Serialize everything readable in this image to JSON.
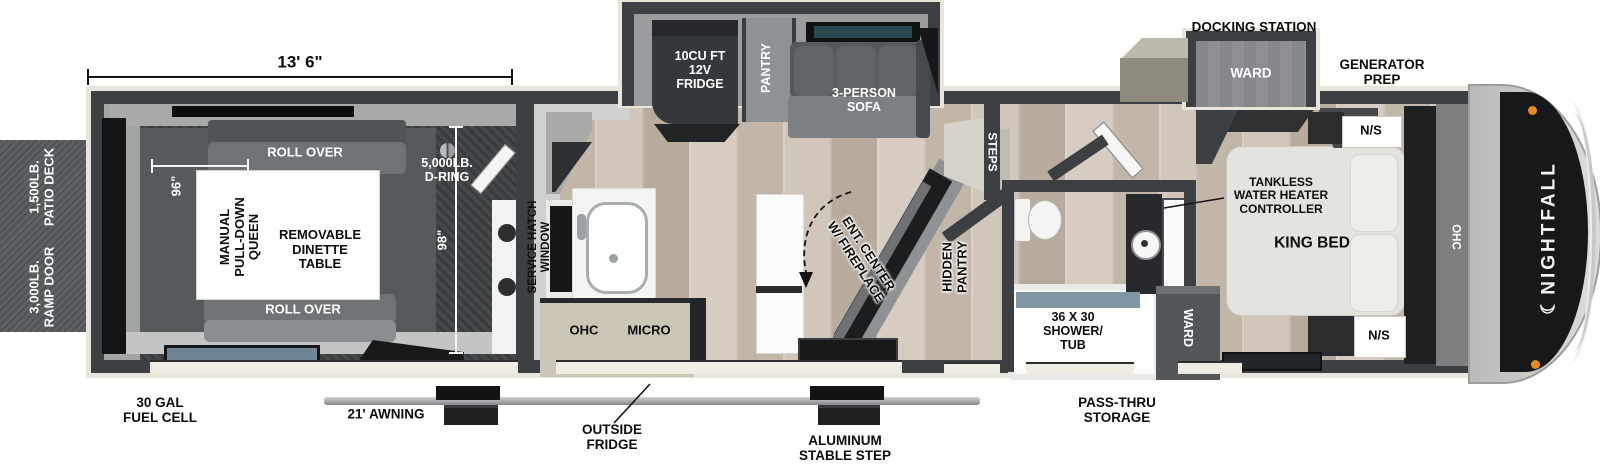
{
  "brand": {
    "logo_text": "NIGHTFALL",
    "moon_icon": "☾"
  },
  "colors": {
    "wall": "#3d4043",
    "outline": "#e9e5da",
    "wood_floor": "#c9beb1",
    "garage_floor": "#45484a",
    "window_teal": "#2b4750",
    "shower_blue": "#7e96a5",
    "cabinet_beige": "#ccc6b7",
    "brand_panel": "#17181a",
    "marker_orange": "#e78c1a",
    "patio_gray": "#5d6163"
  },
  "dimensions": {
    "garage_length": "13' 6\"",
    "garage_width": "96\"",
    "body_width": "98\""
  },
  "exterior": {
    "patio_deck": "1,500LB.\nPATIO DECK",
    "ramp_door": "3,000LB.\nRAMP DOOR",
    "fuel_cell": "30 GAL\nFUEL CELL",
    "awning": "21' AWNING",
    "outside_fridge": "OUTSIDE\nFRIDGE",
    "stable_step": "ALUMINUM\nSTABLE STEP",
    "pass_thru": "PASS-THRU\nSTORAGE",
    "docking_station": "DOCKING STATION",
    "generator_prep": "GENERATOR\nPREP"
  },
  "garage": {
    "roll_over_top": "ROLL OVER",
    "roll_over_bottom": "ROLL OVER",
    "queen_bed": "MANUAL\nPULL-DOWN\nQUEEN",
    "dinette": "REMOVABLE\nDINETTE\nTABLE",
    "d_ring": "5,000LB.\nD-RING"
  },
  "kitchen": {
    "fridge": "10CU FT\n12V\nFRIDGE",
    "pantry": "PANTRY",
    "sofa": "3-PERSON\nSOFA",
    "service_hatch": "SERVICE HATCH\nWINDOW",
    "ohc": "OHC",
    "micro": "MICRO",
    "ent_center": "ENT. CENTER\nW/ FIREPLACE",
    "hidden_pantry": "HIDDEN\nPANTRY",
    "steps": "STEPS"
  },
  "bathroom": {
    "shower_tub": "36 X 30\nSHOWER/\nTUB",
    "tankless": "TANKLESS\nWATER HEATER\nCONTROLLER"
  },
  "bedroom": {
    "ward_slide": "WARD",
    "ward_closet": "WARD",
    "king_bed": "KING BED",
    "night_stand_top": "N/S",
    "night_stand_bottom": "N/S",
    "ohc": "OHC"
  }
}
